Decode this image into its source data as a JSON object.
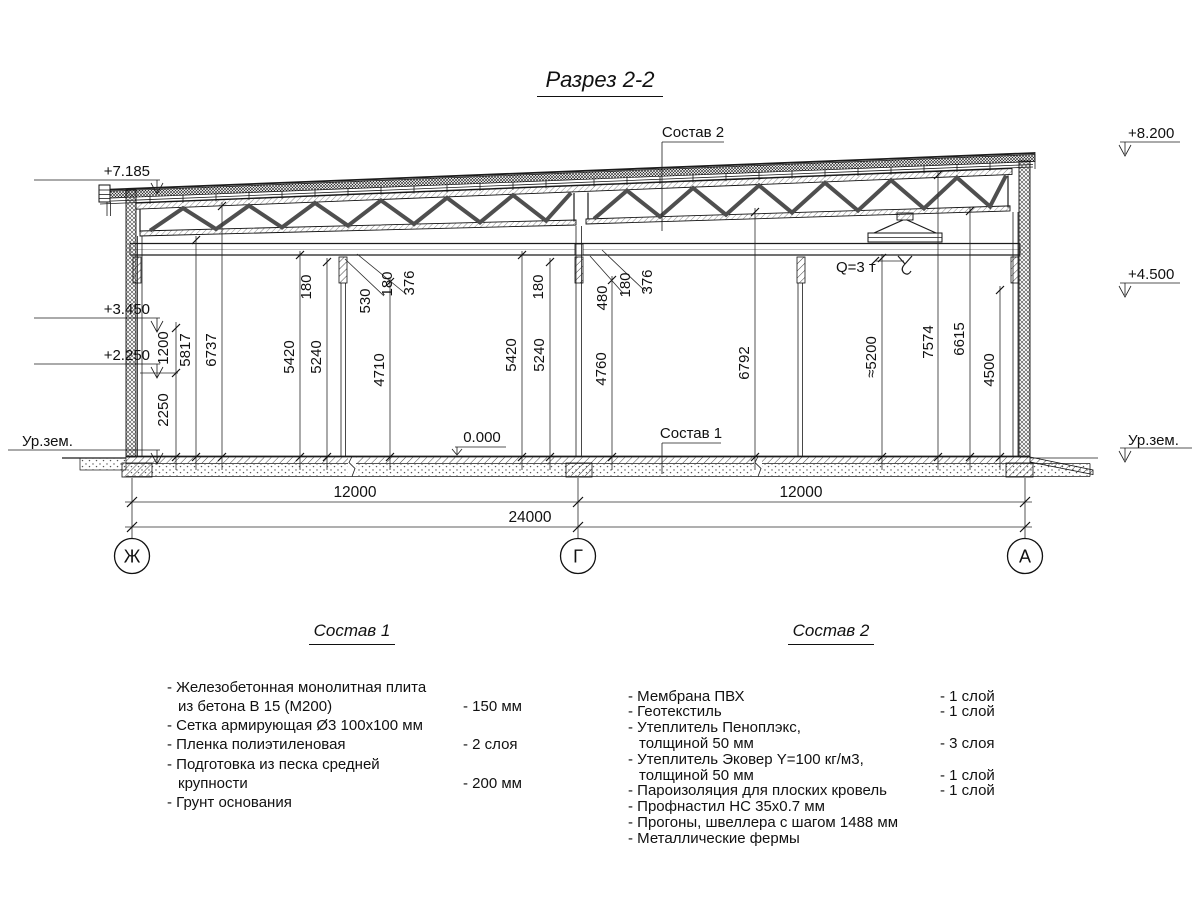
{
  "title": "Разрез 2-2",
  "section": {
    "callout_top": "Состав 2",
    "callout_floor": "Состав 1",
    "zero_level": "0.000",
    "crane_capacity": "Q=3 т",
    "elevations_left": [
      "+7.185",
      "+3.450",
      "+2.250",
      "Ур.зем."
    ],
    "elevations_right": [
      "+8.200",
      "+4.500",
      "Ур.зем."
    ],
    "axes": [
      "Ж",
      "Г",
      "А"
    ],
    "span_dims": [
      "12000",
      "12000",
      "24000"
    ],
    "height_dims": [
      "1200",
      "2250",
      "5817",
      "6737",
      "5420",
      "5240",
      "4710",
      "180",
      "530",
      "180",
      "376",
      "5420",
      "5240",
      "4760",
      "180",
      "480",
      "180",
      "376",
      "6792",
      "≈5200",
      "7574",
      "6615",
      "4500"
    ]
  },
  "legend1": {
    "heading": "Состав 1",
    "rows": [
      {
        "text": "- Железобетонная  монолитная плита",
        "value": ""
      },
      {
        "text": "из бетона В 15 (М200)",
        "value": "- 150 мм"
      },
      {
        "text": "- Сетка армирующая Ø3 100х100 мм",
        "value": ""
      },
      {
        "text": "- Пленка полиэтиленовая",
        "value": "-  2 слоя"
      },
      {
        "text": "- Подготовка из песка средней",
        "value": ""
      },
      {
        "text": "крупности",
        "value": "- 200 мм"
      },
      {
        "text": "- Грунт основания",
        "value": ""
      }
    ]
  },
  "legend2": {
    "heading": "Состав 2",
    "rows": [
      {
        "text": "- Мембрана ПВХ",
        "value": "- 1 слой"
      },
      {
        "text": "- Геотекстиль",
        "value": "- 1 слой"
      },
      {
        "text": "- Утеплитель Пеноплэкс,",
        "value": ""
      },
      {
        "text": "толщиной 50 мм",
        "value": "- 3 слоя"
      },
      {
        "text": "- Утеплитель Эковер Y=100 кг/м3,",
        "value": ""
      },
      {
        "text": "толщиной 50 мм",
        "value": "- 1 слой"
      },
      {
        "text": "- Пароизоляция для плоских кровель",
        "value": "- 1 слой"
      },
      {
        "text": "- Профнастил НС 35х0.7 мм",
        "value": ""
      },
      {
        "text": "- Прогоны, швеллера с шагом 1488 мм",
        "value": ""
      },
      {
        "text": "- Металлические фермы",
        "value": ""
      }
    ]
  }
}
